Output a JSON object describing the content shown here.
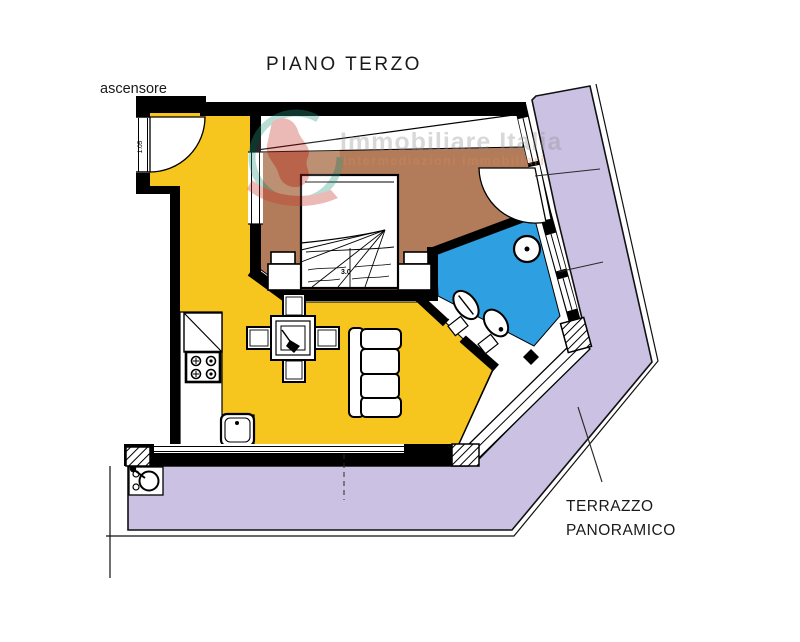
{
  "title": "PIANO TERZO",
  "labels": {
    "elevator": "ascensore",
    "terrace_line1": "TERRAZZO",
    "terrace_line2": "PANORAMICO"
  },
  "watermark": {
    "name": "Immobiliare Italia",
    "tagline": "intermediazioni immobiliari"
  },
  "dimensions": {
    "entrance_door_width": "1.05",
    "bed_width": "3.0"
  },
  "colors": {
    "living_room": "#F6C51E",
    "bedroom": "#B27C5A",
    "bathroom": "#2E9FE0",
    "terrace": "#CBC1E3",
    "walls": "#000000",
    "watermark_text": "#8F8F8F",
    "watermark_tagline": "#D9895A",
    "logo_green": "#2E9E86",
    "logo_red": "#C5352C"
  }
}
